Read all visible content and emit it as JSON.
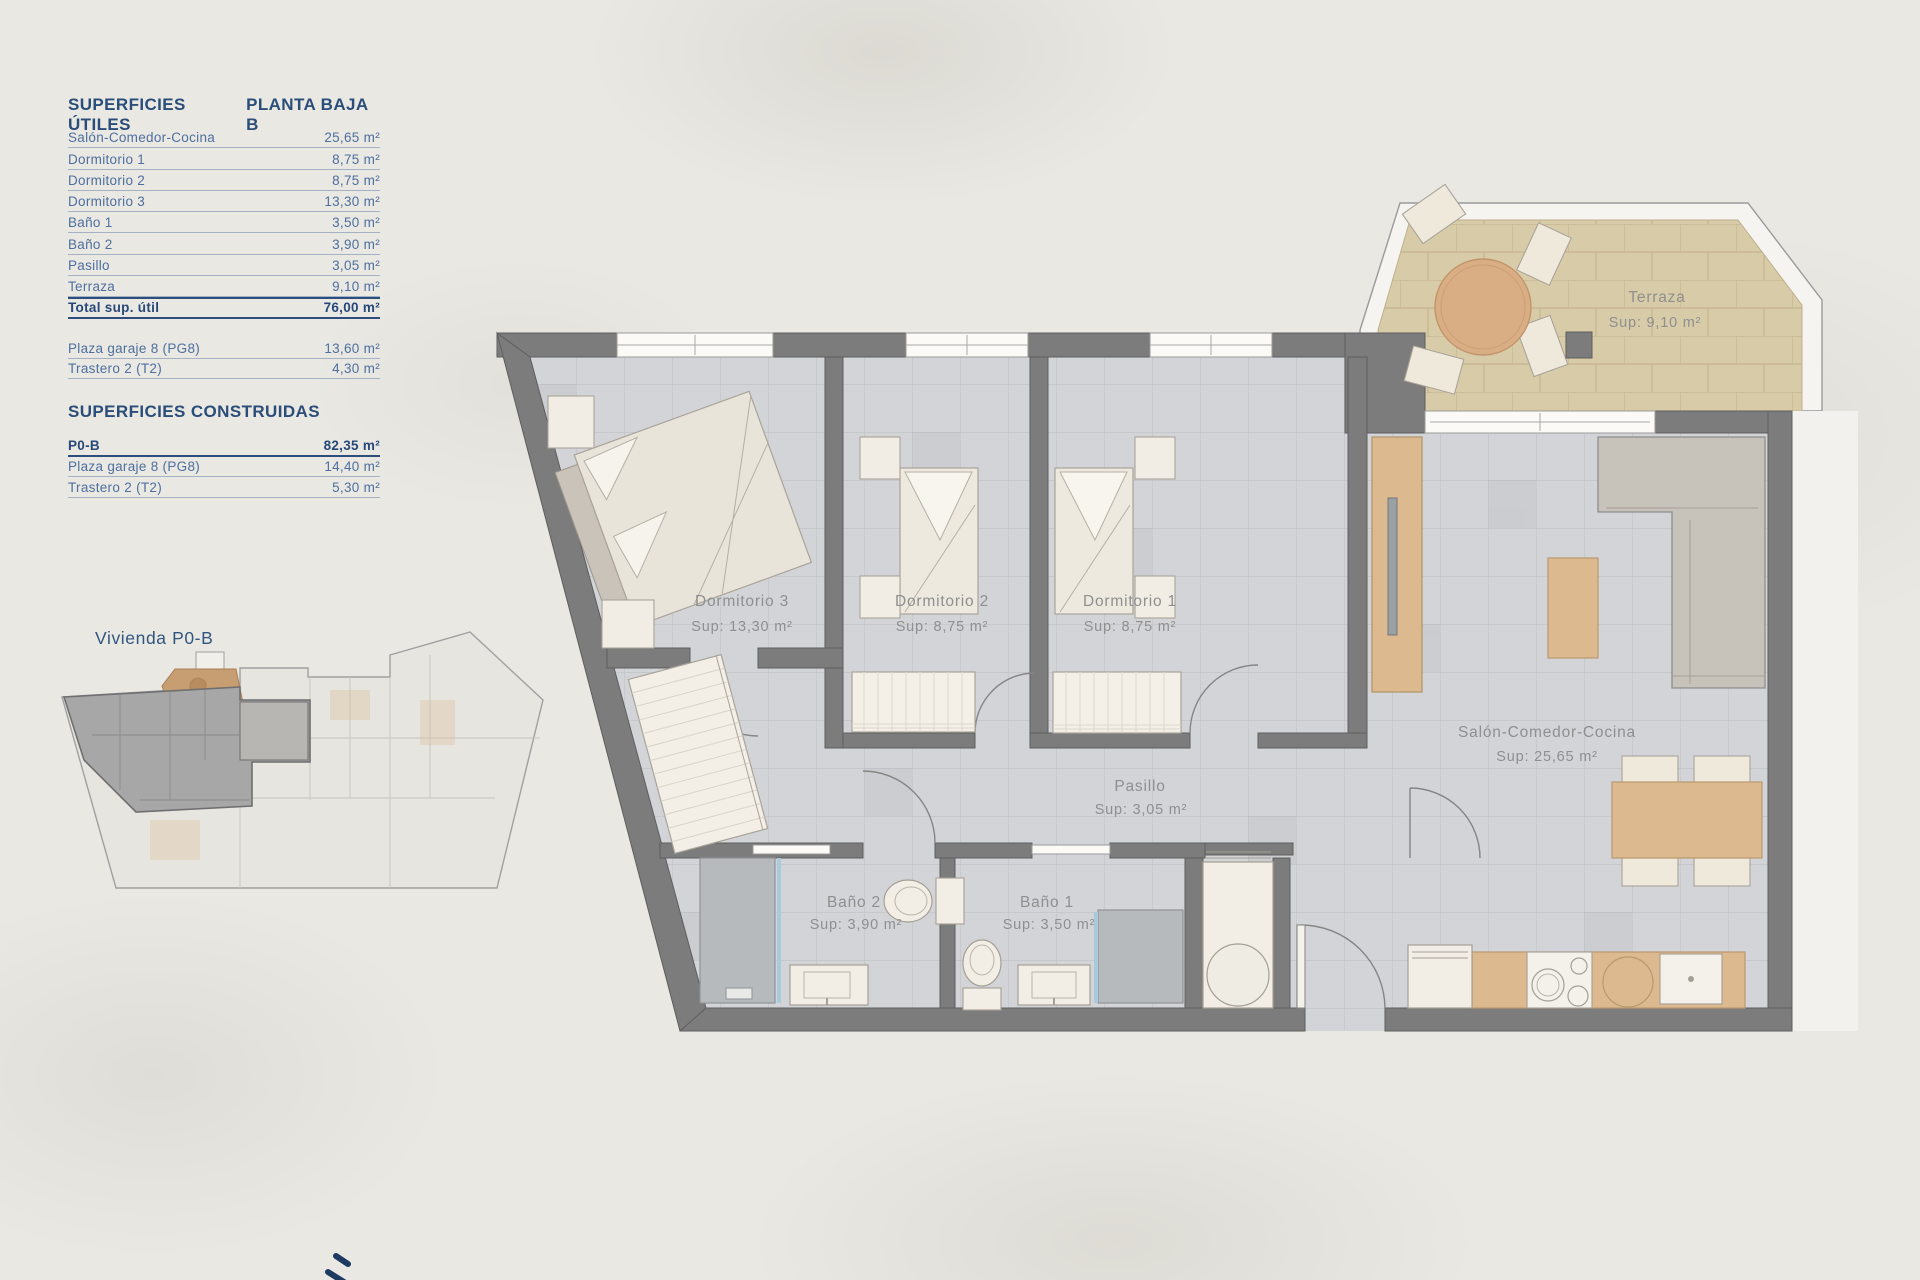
{
  "panel": {
    "utiles": {
      "title": "SUPERFICIES ÚTILES",
      "subtitle": "PLANTA BAJA B",
      "rows": [
        {
          "label": "Salón-Comedor-Cocina",
          "value": "25,65 m²"
        },
        {
          "label": "Dormitorio 1",
          "value": "8,75 m²"
        },
        {
          "label": "Dormitorio 2",
          "value": "8,75 m²"
        },
        {
          "label": "Dormitorio 3",
          "value": "13,30 m²"
        },
        {
          "label": "Baño 1",
          "value": "3,50 m²"
        },
        {
          "label": "Baño 2",
          "value": "3,90 m²"
        },
        {
          "label": "Pasillo",
          "value": "3,05 m²"
        },
        {
          "label": "Terraza",
          "value": "9,10 m²"
        }
      ],
      "total": {
        "label": "Total sup. útil",
        "value": "76,00 m²"
      },
      "annex": [
        {
          "label": "Plaza garaje 8 (PG8)",
          "value": "13,60 m²"
        },
        {
          "label": "Trastero 2 (T2)",
          "value": "4,30 m²"
        }
      ]
    },
    "construidas": {
      "title": "SUPERFICIES CONSTRUIDAS",
      "rows": [
        {
          "label": "P0-B",
          "value": "82,35 m²"
        },
        {
          "label": "Plaza garaje 8 (PG8)",
          "value": "14,40 m²"
        },
        {
          "label": "Trastero 2 (T2)",
          "value": "5,30 m²"
        }
      ]
    }
  },
  "overview": {
    "label": "Vivienda P0-B"
  },
  "plan": {
    "labels": {
      "d3": {
        "name": "Dormitorio 3",
        "sup": "Sup: 13,30 m²"
      },
      "d2": {
        "name": "Dormitorio 2",
        "sup": "Sup: 8,75 m²"
      },
      "d1": {
        "name": "Dormitorio 1",
        "sup": "Sup: 8,75 m²"
      },
      "terraza": {
        "name": "Terraza",
        "sup": "Sup: 9,10 m²"
      },
      "salon": {
        "name": "Salón-Comedor-Cocina",
        "sup": "Sup: 25,65 m²"
      },
      "pasillo": {
        "name": "Pasillo",
        "sup": "Sup: 3,05 m²"
      },
      "b2": {
        "name": "Baño 2",
        "sup": "Sup: 3,90 m²"
      },
      "b1": {
        "name": "Baño 1",
        "sup": "Sup: 3,50 m²"
      }
    }
  },
  "colors": {
    "accent_blue": "#2a4d79",
    "row_blue": "#4e6f9f",
    "wall_gray": "#7c7c7c",
    "floor_tile": "#d3d4d7",
    "terrace_tan": "#d8cba8",
    "wood": "#dcb98f",
    "label_gray": "#8f8f8f"
  }
}
